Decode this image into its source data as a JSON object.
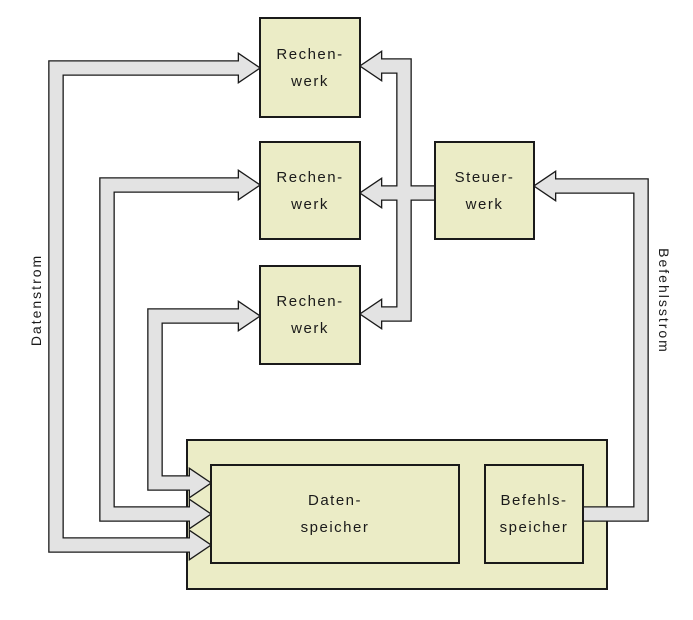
{
  "diagram": {
    "title": "",
    "nodes": {
      "rechenwerk1": {
        "lines": [
          "Rechen-",
          "werk"
        ]
      },
      "rechenwerk2": {
        "lines": [
          "Rechen-",
          "werk"
        ]
      },
      "rechenwerk3": {
        "lines": [
          "Rechen-",
          "werk"
        ]
      },
      "steuerwerk": {
        "lines": [
          "Steuer-",
          "werk"
        ]
      },
      "datenspeicher": {
        "lines": [
          "Daten-",
          "speicher"
        ]
      },
      "befehlsspeicher": {
        "lines": [
          "Befehls-",
          "speicher"
        ]
      }
    },
    "streams": {
      "datenstrom": "Datenstrom",
      "befehlsstrom": "Befehlsstrom"
    },
    "edges": [
      "Datenspeicher <-> Rechenwerk (3 bidirectional data pipes, arrowheads into Rechenwerk and into Datenspeicher)",
      "Steuerwerk -> Rechenwerk 1..3 (control pipes, arrowheads into Rechenwerk)",
      "Befehlsspeicher -> Steuerwerk (instruction pipe, arrowhead into Steuerwerk)"
    ],
    "colors": {
      "node_fill": "#ebecc6",
      "node_border": "#1a1a1a",
      "pipe_fill": "#e3e3e3",
      "pipe_outline": "#1a1a1a",
      "background": "#ffffff"
    }
  }
}
